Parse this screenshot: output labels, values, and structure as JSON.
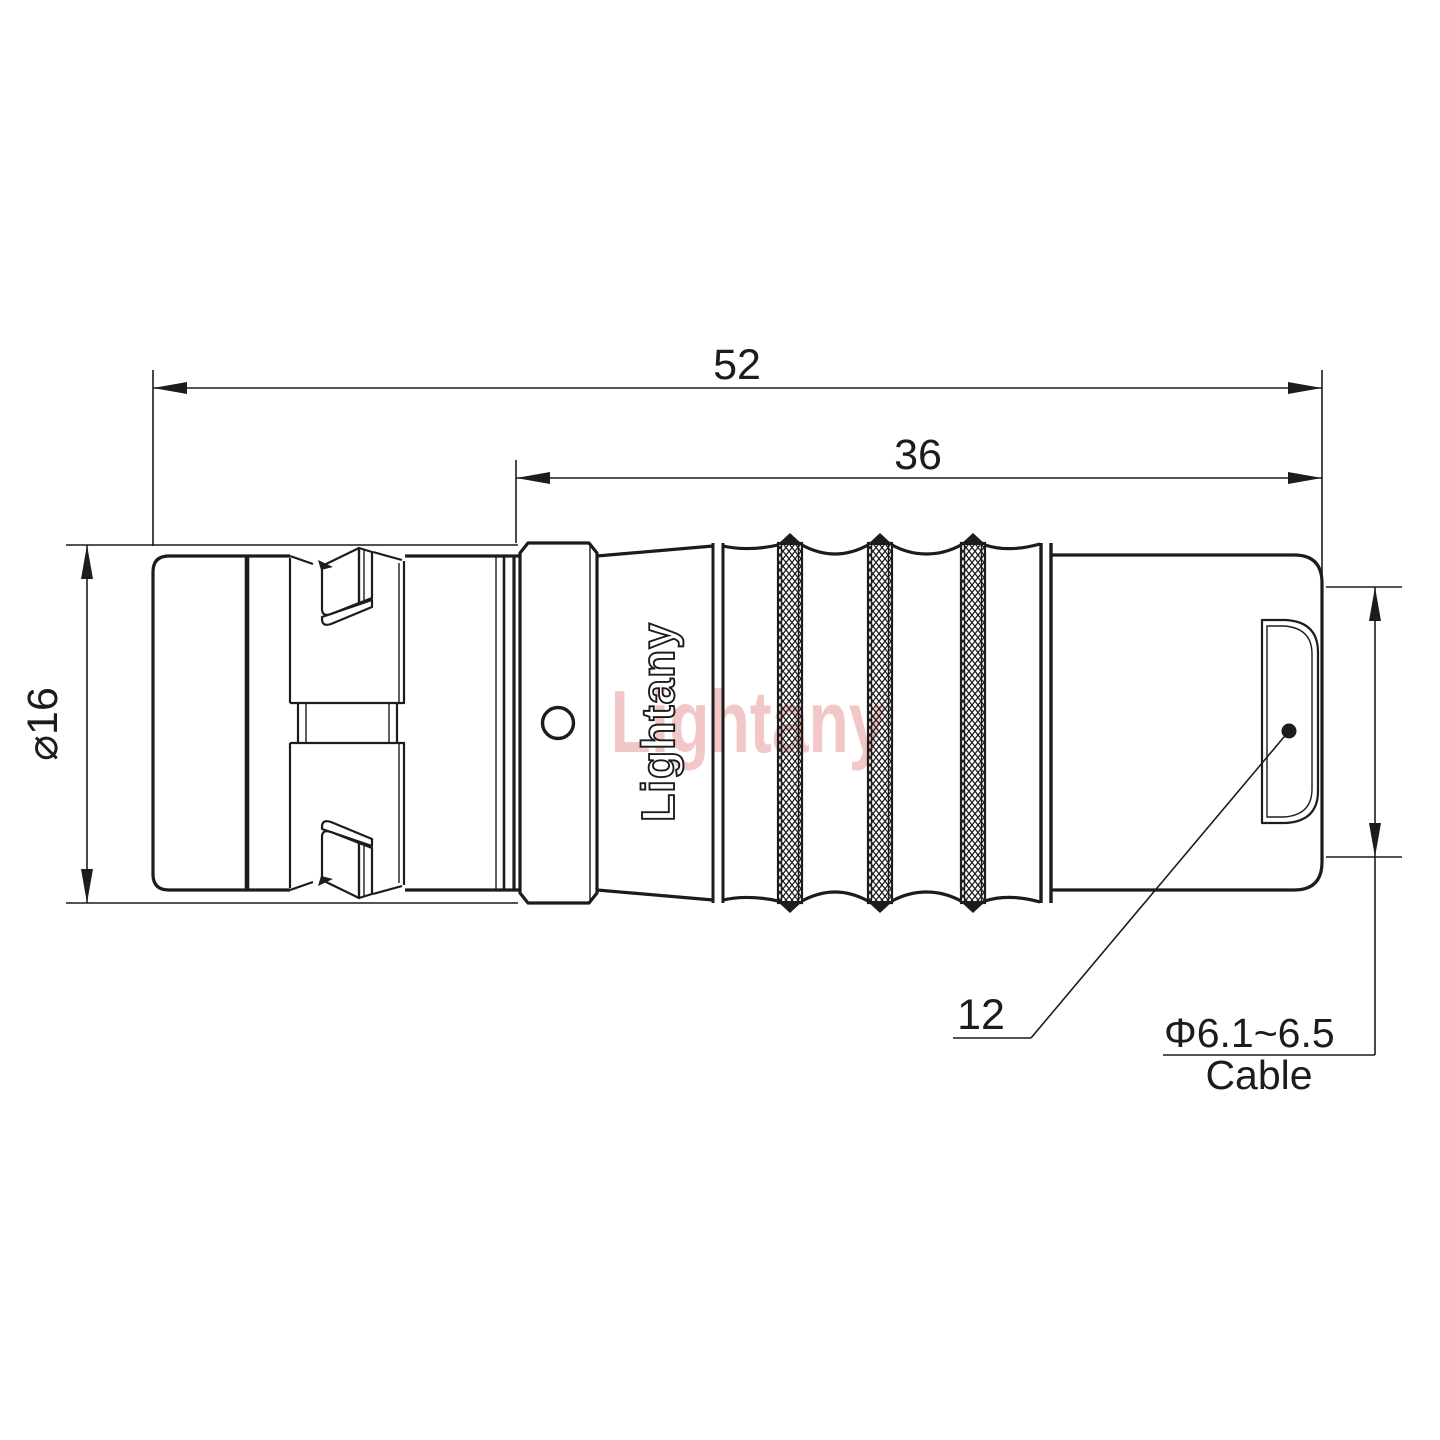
{
  "drawing": {
    "watermark": "Lightany",
    "engraving": "Lightany",
    "dim_overall_length": "52",
    "dim_front_length": "36",
    "dim_diameter": "⌀16",
    "dim_boot": "12",
    "cable_spec": "Φ6.1~6.5",
    "cable_word": "Cable",
    "colors": {
      "line": "#1c1c1c",
      "watermark_pink": "#f2c7c7",
      "background": "#ffffff"
    }
  }
}
